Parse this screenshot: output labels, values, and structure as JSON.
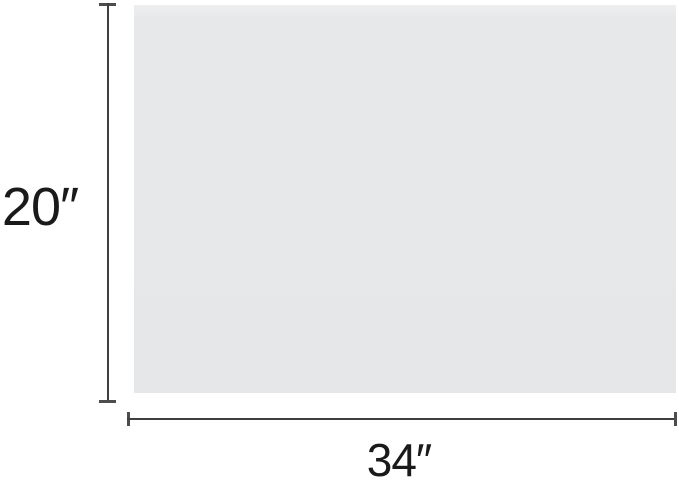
{
  "page": {
    "background_color": "#ffffff"
  },
  "diagram": {
    "panel": {
      "fill_color": "#e7e8ea"
    },
    "dimensions": {
      "height": {
        "label": "20″",
        "value": 20,
        "unit_symbol": "″"
      },
      "width": {
        "label": "34″",
        "value": 34,
        "unit_symbol": "″"
      }
    },
    "line_color": "#3f3f3f",
    "cap_color": "#4d4d4d",
    "text_color": "#1a1a1a"
  }
}
